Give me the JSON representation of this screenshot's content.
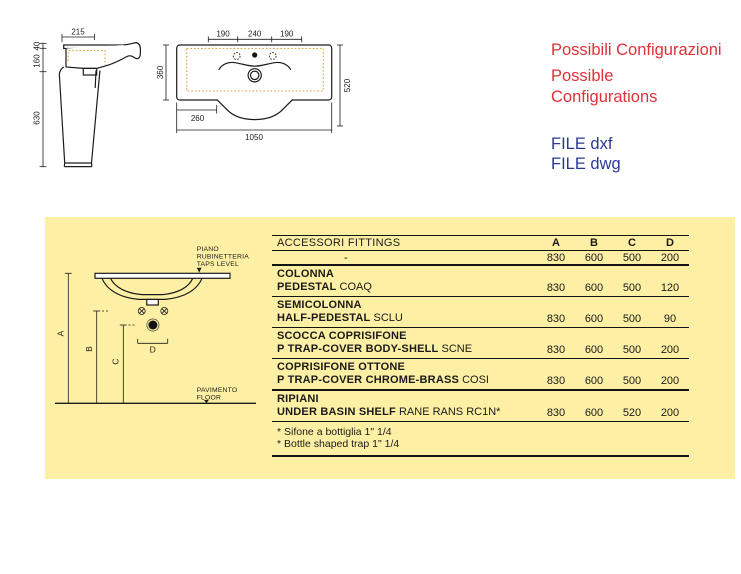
{
  "colors": {
    "panel_yellow": "#fdf0a4",
    "headline_red": "#de3237",
    "file_link_blue": "#293894",
    "drawing_ink": "#1c1c1c",
    "dotted_orange": "#e0a23c"
  },
  "side_view": {
    "top_width": "215",
    "h_top": "40",
    "h_mid": "160",
    "h_bottom": "630"
  },
  "front_view": {
    "w_left": "190",
    "w_center": "240",
    "w_right": "190",
    "depth": "360",
    "height": "520",
    "offset": "260",
    "total_width": "1050"
  },
  "config": {
    "title_it": "Possibili Configurazioni",
    "title_en": "Possible Configurations",
    "file_dxf": "FILE dxf",
    "file_dwg": "FILE dwg"
  },
  "diagram": {
    "taps_line1": "PIANO",
    "taps_line2": "RUBINETTERIA",
    "taps_line3": "TAPS LEVEL",
    "floor_line1": "PAVIMENTO",
    "floor_line2": "FLOOR",
    "dim_a": "A",
    "dim_b": "B",
    "dim_c": "C",
    "dim_d": "D"
  },
  "table": {
    "header_label": "ACCESSORI FITTINGS",
    "columns": [
      "A",
      "B",
      "C",
      "D"
    ],
    "base_row": {
      "label": "-",
      "values": [
        "830",
        "600",
        "500",
        "200"
      ]
    },
    "rows": [
      {
        "name_it": "COLONNA",
        "name_en": "PEDESTAL",
        "code": "COAQ",
        "values": [
          "830",
          "600",
          "500",
          "120"
        ]
      },
      {
        "name_it": "SEMICOLONNA",
        "name_en": "HALF-PEDESTAL",
        "code": "SCLU",
        "values": [
          "830",
          "600",
          "500",
          "90"
        ]
      },
      {
        "name_it": "SCOCCA COPRISIFONE",
        "name_en": "P TRAP-COVER BODY-SHELL",
        "code": "SCNE",
        "values": [
          "830",
          "600",
          "500",
          "200"
        ]
      },
      {
        "name_it": "COPRISIFONE OTTONE",
        "name_en": "P TRAP-COVER CHROME-BRASS",
        "code": "COSI",
        "values": [
          "830",
          "600",
          "500",
          "200"
        ]
      },
      {
        "name_it": "RIPIANI",
        "name_en": "UNDER BASIN SHELF",
        "code": "RANE RANS RC1N*",
        "values": [
          "830",
          "600",
          "520",
          "200"
        ]
      }
    ],
    "footnotes": [
      "* Sifone a bottiglia 1\" 1/4",
      "* Bottle shaped trap 1\" 1/4"
    ]
  }
}
